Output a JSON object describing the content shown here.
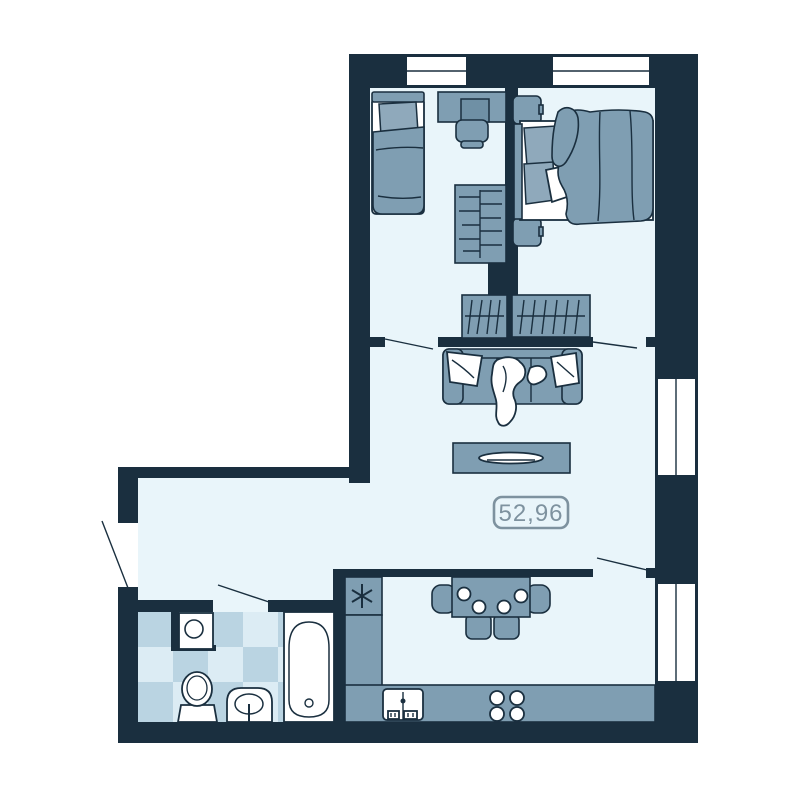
{
  "floorplan": {
    "area_label": "52,96",
    "colors": {
      "wall": "#1a2f3f",
      "floor": "#e9f5fa",
      "furniture": "#7f9eb2",
      "furniture_light": "#8fa9bb",
      "tile_dark": "#bad4e2",
      "tile_light": "#dcecf4",
      "fixture_white": "#ffffff",
      "area_label_color": "#7e929f"
    },
    "icons": [
      "single-bed",
      "pillow",
      "desk",
      "desk-chair",
      "shelf-wardrobe",
      "hanging-wardrobe",
      "double-bed",
      "nightstand",
      "sofa",
      "sofa-pillow",
      "throw-blanket",
      "coffee-table",
      "serving-plate",
      "dining-table",
      "dining-chair",
      "plate",
      "fridge-asterisk",
      "kitchen-counter",
      "kitchen-sink",
      "stove-burner",
      "washing-machine",
      "toilet",
      "wash-basin",
      "bathtub",
      "window",
      "door-swing-line"
    ]
  }
}
